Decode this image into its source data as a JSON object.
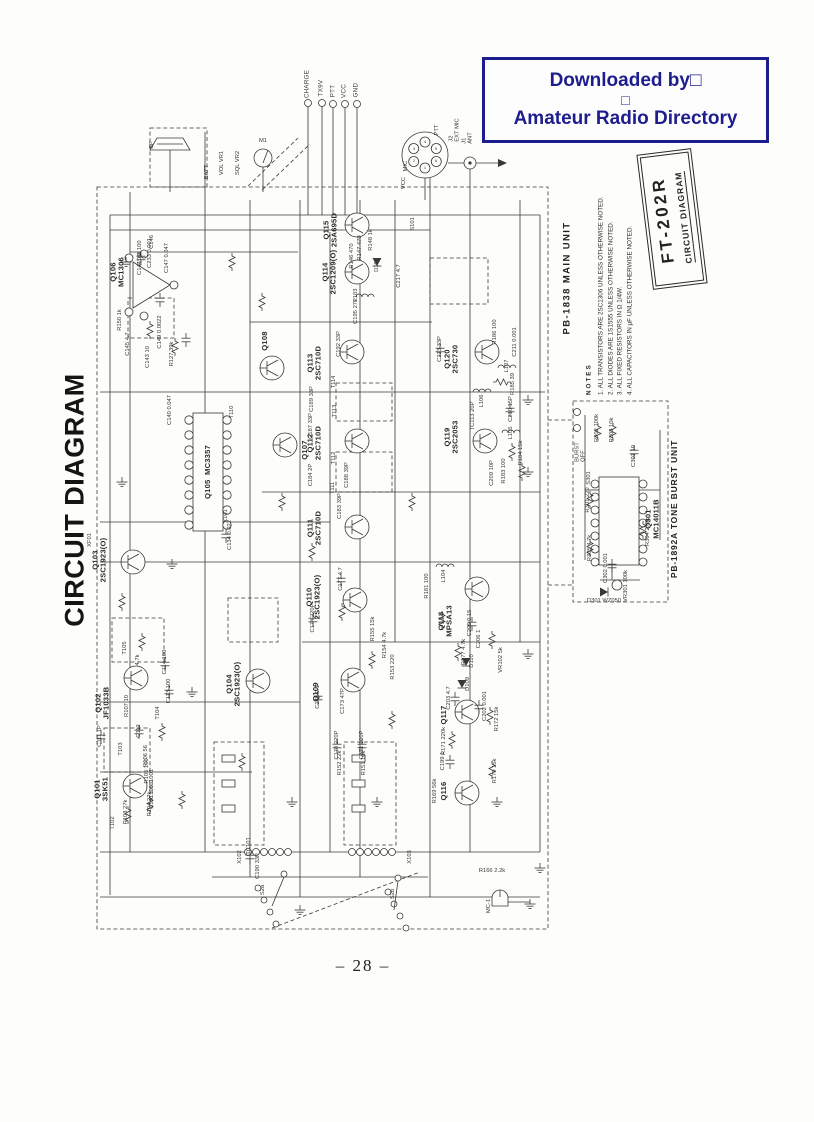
{
  "watermark": {
    "line1": "Downloaded by□",
    "line2": "□",
    "line3": "Amateur Radio Directory",
    "color": "#1d1d8d"
  },
  "titles": {
    "side_title": "CIRCUIT DIAGRAM",
    "model": "FT-202R",
    "model_subtitle": "CIRCUIT DIAGRAM",
    "main_unit": "PB-1838 MAIN UNIT",
    "tone_burst_unit": "PB-1892A TONE BURST UNIT"
  },
  "notes": {
    "heading": "NOTES",
    "items": [
      "1. ALL TRANSISTORS ARE 2SC1306 UNLESS OTHERWISE NOTED.",
      "2. ALL DIODES ARE 1S1555 UNLESS OTHERWISE NOTED.",
      "3. ALL FIXED RESISTORS IN Ω  1/4W.",
      "4. ALL CAPACITORS IN µF UNLESS OTHERWISE NOTED."
    ]
  },
  "page": {
    "number_label": "– 28 –"
  },
  "terminals": [
    {
      "t": "CHARGE",
      "x": 308,
      "y": 84
    },
    {
      "t": "TX9V",
      "x": 322,
      "y": 88
    },
    {
      "t": "PTT",
      "x": 334,
      "y": 91
    },
    {
      "t": "VCC",
      "x": 345,
      "y": 91
    },
    {
      "t": "GND",
      "x": 357,
      "y": 90
    }
  ],
  "semiconductors": [
    {
      "t": "Q101\n3SK51",
      "x": 102,
      "y": 789
    },
    {
      "t": "Q102\nJF1033B",
      "x": 103,
      "y": 703
    },
    {
      "t": "Q103\n2SC1923(O)",
      "x": 100,
      "y": 560
    },
    {
      "t": "Q104\n2SC1923(O)",
      "x": 234,
      "y": 684
    },
    {
      "t": "Q105  MC3357",
      "x": 208,
      "y": 472
    },
    {
      "t": "Q106\nMC1306",
      "x": 118,
      "y": 272
    },
    {
      "t": "Q107",
      "x": 305,
      "y": 450
    },
    {
      "t": "Q108",
      "x": 265,
      "y": 341
    },
    {
      "t": "Q109",
      "x": 316,
      "y": 692
    },
    {
      "t": "Q110\n2SC1923(O)",
      "x": 314,
      "y": 597
    },
    {
      "t": "Q111\n2SC710D",
      "x": 315,
      "y": 528
    },
    {
      "t": "Q112\n2SC710D",
      "x": 315,
      "y": 443
    },
    {
      "t": "Q113\n2SC710D",
      "x": 315,
      "y": 363
    },
    {
      "t": "Q114\n2SC1209(O)",
      "x": 330,
      "y": 272
    },
    {
      "t": "Q115\n2SA695D",
      "x": 331,
      "y": 230
    },
    {
      "t": "Q116",
      "x": 444,
      "y": 791
    },
    {
      "t": "Q117",
      "x": 444,
      "y": 715
    },
    {
      "t": "Q118\nMPSA13",
      "x": 446,
      "y": 621
    },
    {
      "t": "Q119\n2SC2053",
      "x": 452,
      "y": 437
    },
    {
      "t": "Q120\n2SC730",
      "x": 452,
      "y": 359
    },
    {
      "t": "Q301\nMC14011B",
      "x": 653,
      "y": 519
    }
  ],
  "labels": [
    {
      "t": "SP",
      "x": 152,
      "y": 145
    },
    {
      "t": "M1",
      "x": 263,
      "y": 141,
      "r": 0
    },
    {
      "t": "VOL VR1",
      "x": 222,
      "y": 163
    },
    {
      "t": "SQL VR2",
      "x": 238,
      "y": 163
    },
    {
      "t": "BATT",
      "x": 207,
      "y": 172
    },
    {
      "t": "J2\nEXT MIC",
      "x": 455,
      "y": 130
    },
    {
      "t": "J1\nANT",
      "x": 468,
      "y": 138
    },
    {
      "t": "MIC",
      "x": 406,
      "y": 166
    },
    {
      "t": "PTT",
      "x": 437,
      "y": 130
    },
    {
      "t": "VCC",
      "x": 404,
      "y": 183
    },
    {
      "t": "S101",
      "x": 413,
      "y": 224
    },
    {
      "t": "XF01",
      "x": 90,
      "y": 540
    },
    {
      "t": "X101",
      "x": 226,
      "y": 516
    },
    {
      "t": "1",
      "x": 425,
      "y": 168,
      "r": 0,
      "s": 4
    },
    {
      "t": "2",
      "x": 414,
      "y": 161,
      "r": 0,
      "s": 4
    },
    {
      "t": "3",
      "x": 414,
      "y": 149,
      "r": 0,
      "s": 4
    },
    {
      "t": "4",
      "x": 425,
      "y": 142,
      "r": 0,
      "s": 4
    },
    {
      "t": "5",
      "x": 436,
      "y": 149,
      "r": 0,
      "s": 4
    },
    {
      "t": "6",
      "x": 436,
      "y": 161,
      "r": 0,
      "s": 4
    },
    {
      "t": "C148 100",
      "x": 140,
      "y": 253
    },
    {
      "t": "C233 0.001",
      "x": 150,
      "y": 253
    },
    {
      "t": "C146",
      "x": 152,
      "y": 242
    },
    {
      "t": "C144 10",
      "x": 140,
      "y": 264
    },
    {
      "t": "C147 0.047",
      "x": 167,
      "y": 258
    },
    {
      "t": "R150 1k",
      "x": 120,
      "y": 320
    },
    {
      "t": "C145 4.7",
      "x": 128,
      "y": 344
    },
    {
      "t": "C149 0.0022",
      "x": 160,
      "y": 332
    },
    {
      "t": "C143 10",
      "x": 148,
      "y": 357
    },
    {
      "t": "R127 39k",
      "x": 172,
      "y": 354
    },
    {
      "t": "C140 0.047",
      "x": 170,
      "y": 410
    },
    {
      "t": "T110",
      "x": 232,
      "y": 412
    },
    {
      "t": "C134 0.022",
      "x": 230,
      "y": 535
    },
    {
      "t": "C111 1P",
      "x": 100,
      "y": 736
    },
    {
      "t": "C112",
      "x": 139,
      "y": 731
    },
    {
      "t": "T104",
      "x": 158,
      "y": 713
    },
    {
      "t": "R107 10",
      "x": 127,
      "y": 706
    },
    {
      "t": "C113 100",
      "x": 169,
      "y": 691
    },
    {
      "t": "C114 100",
      "x": 165,
      "y": 662
    },
    {
      "t": "4.7k",
      "x": 138,
      "y": 660
    },
    {
      "t": "R106 56",
      "x": 146,
      "y": 756
    },
    {
      "t": "T103",
      "x": 121,
      "y": 749
    },
    {
      "t": "R105 100",
      "x": 147,
      "y": 771
    },
    {
      "t": "C108 0.001",
      "x": 152,
      "y": 784
    },
    {
      "t": "C107 0.001",
      "x": 152,
      "y": 794
    },
    {
      "t": "R104 27k",
      "x": 150,
      "y": 804
    },
    {
      "t": "R103 27k",
      "x": 126,
      "y": 812
    },
    {
      "t": "T102",
      "x": 113,
      "y": 823
    },
    {
      "t": "T105",
      "x": 125,
      "y": 648
    },
    {
      "t": "C192 33P",
      "x": 339,
      "y": 344
    },
    {
      "t": "T114",
      "x": 334,
      "y": 382
    },
    {
      "t": "C189 33P",
      "x": 312,
      "y": 399
    },
    {
      "t": "T113",
      "x": 335,
      "y": 411
    },
    {
      "t": "C187 33P",
      "x": 311,
      "y": 426
    },
    {
      "t": "T112",
      "x": 334,
      "y": 458
    },
    {
      "t": "C188 39P",
      "x": 347,
      "y": 475
    },
    {
      "t": "C184 2P",
      "x": 311,
      "y": 475
    },
    {
      "t": "T111",
      "x": 333,
      "y": 488
    },
    {
      "t": "C183 39P",
      "x": 340,
      "y": 506
    },
    {
      "t": "L103",
      "x": 356,
      "y": 295
    },
    {
      "t": "C195 27P",
      "x": 356,
      "y": 311
    },
    {
      "t": "R148 1k",
      "x": 371,
      "y": 240
    },
    {
      "t": "R147 470",
      "x": 360,
      "y": 248
    },
    {
      "t": "R146 470",
      "x": 352,
      "y": 256
    },
    {
      "t": "D107",
      "x": 377,
      "y": 265
    },
    {
      "t": "C217 4.7",
      "x": 399,
      "y": 276
    },
    {
      "t": "C174 220P",
      "x": 313,
      "y": 618
    },
    {
      "t": "C177 4.7",
      "x": 341,
      "y": 579
    },
    {
      "t": "R155 15k",
      "x": 373,
      "y": 629
    },
    {
      "t": "R154 4.7k",
      "x": 385,
      "y": 645
    },
    {
      "t": "R153 220",
      "x": 393,
      "y": 667
    },
    {
      "t": "C173 47P",
      "x": 343,
      "y": 701
    },
    {
      "t": "C172 0.1",
      "x": 318,
      "y": 697
    },
    {
      "t": "C171 100P",
      "x": 362,
      "y": 745
    },
    {
      "t": "C170 220P",
      "x": 337,
      "y": 745
    },
    {
      "t": "R151 10k",
      "x": 364,
      "y": 763
    },
    {
      "t": "R152 22k",
      "x": 340,
      "y": 763
    },
    {
      "t": "C213 33P",
      "x": 440,
      "y": 349
    },
    {
      "t": "R186 100",
      "x": 495,
      "y": 332
    },
    {
      "t": "C211 0.001",
      "x": 515,
      "y": 342
    },
    {
      "t": "L107",
      "x": 507,
      "y": 366
    },
    {
      "t": "R185 39",
      "x": 513,
      "y": 384
    },
    {
      "t": "L106",
      "x": 482,
      "y": 401
    },
    {
      "t": "C210 15P",
      "x": 511,
      "y": 409
    },
    {
      "t": "TC113 20P",
      "x": 473,
      "y": 416
    },
    {
      "t": "L105",
      "x": 511,
      "y": 433
    },
    {
      "t": "R184 15k",
      "x": 521,
      "y": 453
    },
    {
      "t": "R183 100",
      "x": 504,
      "y": 471
    },
    {
      "t": "C209 10P",
      "x": 492,
      "y": 473
    },
    {
      "t": "R181 100",
      "x": 427,
      "y": 586
    },
    {
      "t": "L104",
      "x": 444,
      "y": 576
    },
    {
      "t": "C205 0.15",
      "x": 470,
      "y": 623
    },
    {
      "t": "C206 1",
      "x": 479,
      "y": 639
    },
    {
      "t": "R177 4.7k",
      "x": 464,
      "y": 652
    },
    {
      "t": "D110",
      "x": 472,
      "y": 661
    },
    {
      "t": "D109",
      "x": 468,
      "y": 684
    },
    {
      "t": "VR102 5k",
      "x": 501,
      "y": 660
    },
    {
      "t": "C203 4.7",
      "x": 449,
      "y": 698
    },
    {
      "t": "C202 0.001",
      "x": 485,
      "y": 706
    },
    {
      "t": "R172 15k",
      "x": 497,
      "y": 719
    },
    {
      "t": "R171 220k",
      "x": 444,
      "y": 741
    },
    {
      "t": "C199 1",
      "x": 443,
      "y": 761
    },
    {
      "t": "R170 15k",
      "x": 495,
      "y": 771
    },
    {
      "t": "R169 56k",
      "x": 435,
      "y": 791
    },
    {
      "t": "R166 2.2k",
      "x": 492,
      "y": 871,
      "r": 0
    },
    {
      "t": "MC-1",
      "x": 489,
      "y": 906
    },
    {
      "t": "S2a",
      "x": 263,
      "y": 890
    },
    {
      "t": "S2b",
      "x": 393,
      "y": 894
    },
    {
      "t": "X102",
      "x": 240,
      "y": 857
    },
    {
      "t": "X103",
      "x": 410,
      "y": 857
    },
    {
      "t": "TC101",
      "x": 249,
      "y": 846
    },
    {
      "t": "C190 33P",
      "x": 258,
      "y": 866
    },
    {
      "t": "R302 100k",
      "x": 597,
      "y": 428
    },
    {
      "t": "R303 10k",
      "x": 612,
      "y": 430
    },
    {
      "t": "C301 10",
      "x": 634,
      "y": 456
    },
    {
      "t": "R301 220",
      "x": 588,
      "y": 500
    },
    {
      "t": "R304 270k",
      "x": 648,
      "y": 532
    },
    {
      "t": "R305 4.7k",
      "x": 590,
      "y": 548
    },
    {
      "t": "C302 0.001",
      "x": 606,
      "y": 568
    },
    {
      "t": "VR301 100k",
      "x": 626,
      "y": 586
    },
    {
      "t": "D301 WZ050",
      "x": 604,
      "y": 601,
      "r": 0
    },
    {
      "t": "BURST\nOFF",
      "x": 581,
      "y": 452
    },
    {
      "t": "S301",
      "x": 589,
      "y": 478
    }
  ]
}
